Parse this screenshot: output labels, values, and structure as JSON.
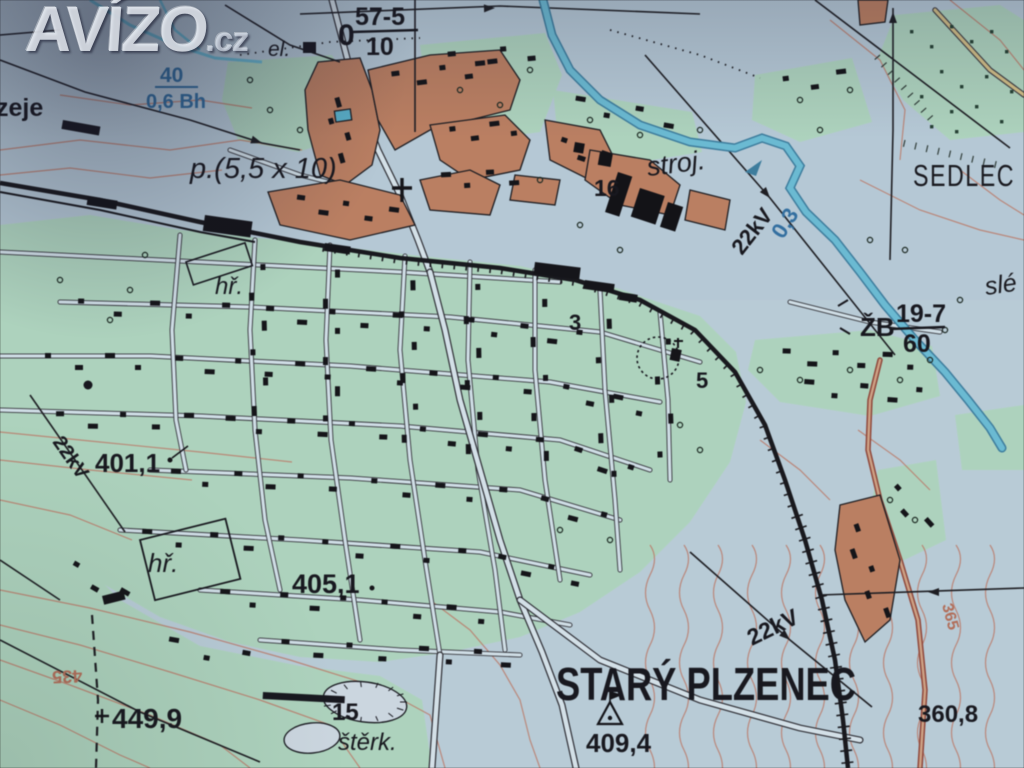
{
  "watermark": {
    "brand": "AVÍZO",
    "tld": ".cz"
  },
  "labels": {
    "town": "STARÝ PLZENEC",
    "sedlec": "SEDLEC",
    "edge_left": "zeje",
    "edge_right_foundry": "slé",
    "el": "el.",
    "el_parcel": "p.(5,5 x 10)",
    "stroj": "stroj.",
    "num16": "16",
    "num3": "3",
    "num5": "5",
    "num15": "15",
    "sterk": "štěrk.",
    "hr_north": "hř.",
    "hr_south": "hř.",
    "frac_zero": "0",
    "frac_top": "57-5",
    "frac_bottom": "10",
    "zb": "ŽB",
    "zb_top": "19-7",
    "zb_bottom": "60",
    "elev401": "401,1",
    "elev405": "405,1",
    "elev409": "409,4",
    "elev449": "449,9",
    "elev360": "360,8",
    "kv22_river": "22kV",
    "kv22_west": "22kV",
    "kv22_south": "22kV",
    "river_width": "40",
    "river_class": "0,6 Bh",
    "river_depth": "0,3",
    "contour_435": "435",
    "contour_365": "365"
  },
  "colors": {
    "background": "#b7cfdd",
    "green_area": "#a9d8bd",
    "urban_block": "#c87d58",
    "water": "#57b3d3",
    "contour": "#c97862",
    "ink": "#14141c",
    "water_text": "#2470ae",
    "contour_text": "#c06a50"
  }
}
